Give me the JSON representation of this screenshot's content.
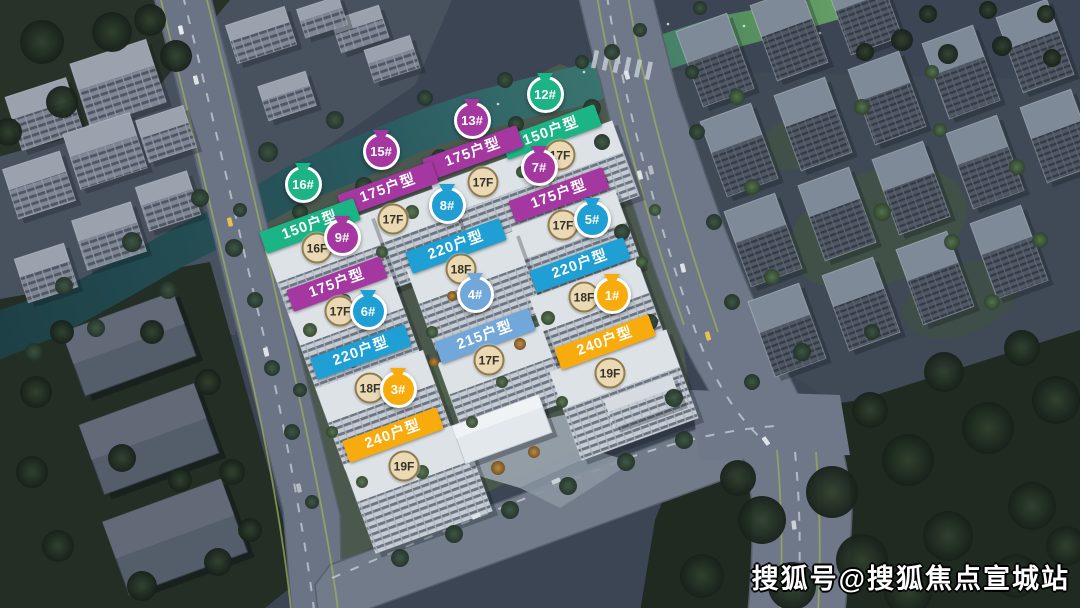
{
  "watermark": {
    "text": "搜狐号@搜狐焦点宣城站"
  },
  "colors": {
    "green": "#1db485",
    "purple": "#a438a0",
    "cyan": "#1f9fd4",
    "blue": "#72a7da",
    "orange": "#f8ab0c",
    "pin_ring": "#ffffff",
    "banner_text": "#ffffff",
    "badge_bg": "#ead9b3",
    "badge_border": "#8f7c50",
    "badge_text": "#32302a"
  },
  "markers": [
    {
      "building": "12#",
      "unit_type": "150户型",
      "floors": "17F",
      "color": "green",
      "pin": [
        545,
        95
      ],
      "banner": [
        551,
        132
      ],
      "badge": [
        560,
        155
      ]
    },
    {
      "building": "13#",
      "unit_type": "175户型",
      "floors": "17F",
      "color": "purple",
      "pin": [
        472,
        121
      ],
      "banner": [
        473,
        153
      ],
      "badge": [
        483,
        182
      ]
    },
    {
      "building": "15#",
      "unit_type": "175户型",
      "floors": "17F",
      "color": "purple",
      "pin": [
        381,
        152
      ],
      "banner": [
        388,
        189
      ],
      "badge": [
        393,
        219
      ]
    },
    {
      "building": "16#",
      "unit_type": "150户型",
      "floors": "16F",
      "color": "green",
      "pin": [
        303,
        185
      ],
      "banner": [
        310,
        226
      ],
      "badge": [
        317,
        248
      ]
    },
    {
      "building": "7#",
      "unit_type": "175户型",
      "floors": "17F",
      "color": "purple",
      "pin": [
        539,
        168
      ],
      "banner": [
        559,
        195
      ],
      "badge": [
        563,
        225
      ]
    },
    {
      "building": "8#",
      "unit_type": "220户型",
      "floors": "18F",
      "color": "cyan",
      "pin": [
        447,
        206
      ],
      "banner": [
        456,
        246
      ],
      "badge": [
        461,
        269
      ]
    },
    {
      "building": "9#",
      "unit_type": "175户型",
      "floors": "17F",
      "color": "purple",
      "pin": [
        342,
        238
      ],
      "banner": [
        337,
        284
      ],
      "badge": [
        340,
        311
      ]
    },
    {
      "building": "5#",
      "unit_type": "220户型",
      "floors": "18F",
      "color": "cyan",
      "pin": [
        592,
        220
      ],
      "banner": [
        580,
        265
      ],
      "badge": [
        584,
        297
      ]
    },
    {
      "building": "6#",
      "unit_type": "220户型",
      "floors": "18F",
      "color": "cyan",
      "pin": [
        368,
        312
      ],
      "banner": [
        361,
        352
      ],
      "badge": [
        370,
        388
      ]
    },
    {
      "building": "4#",
      "unit_type": "215户型",
      "floors": "17F",
      "color": "blue",
      "pin": [
        475,
        295
      ],
      "banner": [
        485,
        336
      ],
      "badge": [
        489,
        360
      ]
    },
    {
      "building": "1#",
      "unit_type": "240户型",
      "floors": "19F",
      "color": "orange",
      "pin": [
        612,
        296
      ],
      "banner": [
        605,
        342
      ],
      "badge": [
        610,
        373
      ]
    },
    {
      "building": "3#",
      "unit_type": "240户型",
      "floors": "19F",
      "color": "orange",
      "pin": [
        398,
        390
      ],
      "banner": [
        393,
        435
      ],
      "badge": [
        404,
        466
      ]
    }
  ]
}
